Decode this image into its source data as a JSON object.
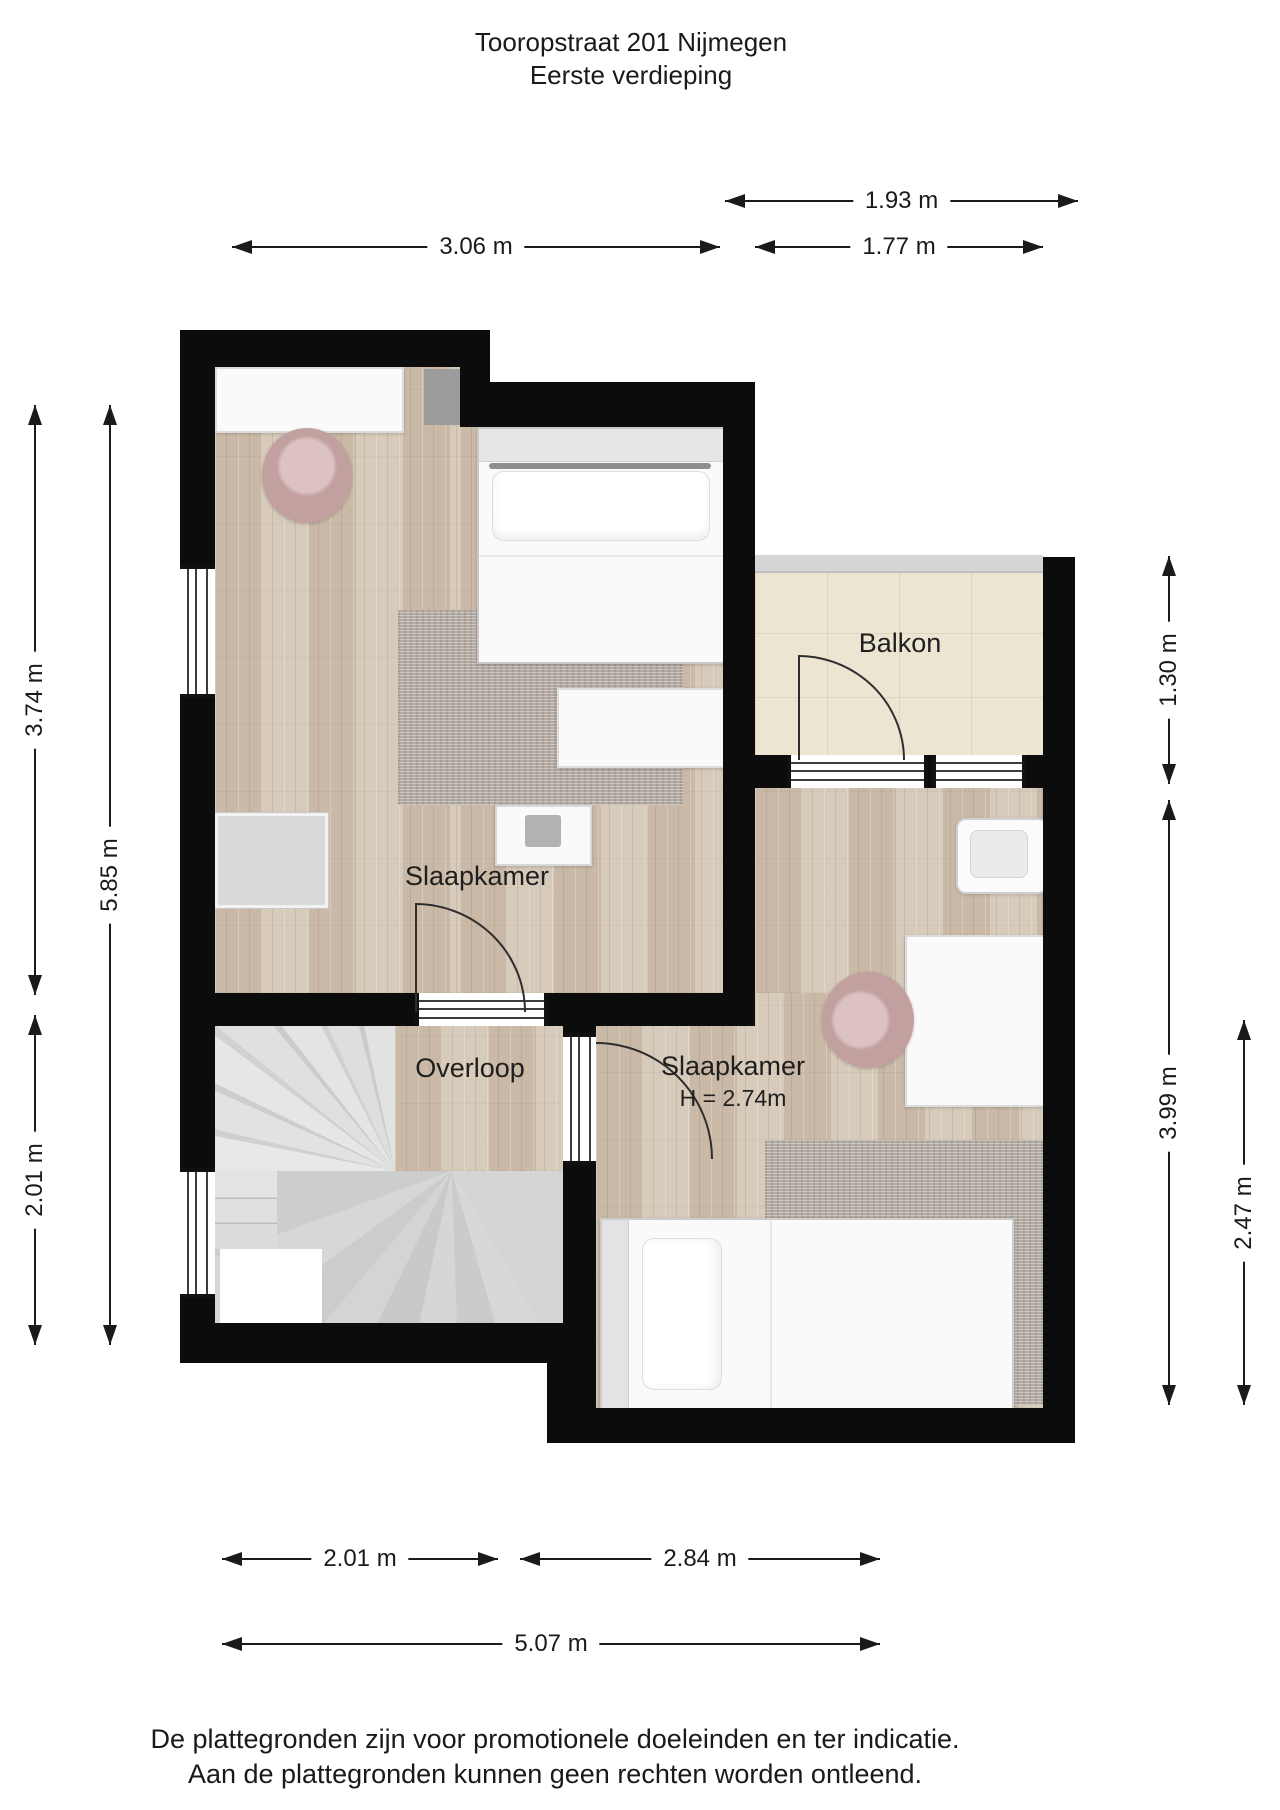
{
  "header": {
    "address": "Tooropstraat 201 Nijmegen",
    "floor": "Eerste verdieping"
  },
  "rooms": {
    "bedroom_left": {
      "label": "Slaapkamer"
    },
    "landing": {
      "label": "Overloop"
    },
    "bedroom_right": {
      "label": "Slaapkamer",
      "ceiling_height": "H = 2.74m"
    },
    "balcony": {
      "label": "Balkon"
    }
  },
  "dimensions": {
    "balcony_width": "1.93 m",
    "bedroom_left_width": "3.06 m",
    "balcony_inner_width": "1.77 m",
    "bedroom_left_depth": "3.74 m",
    "left_side_total": "5.85 m",
    "landing_depth": "2.01 m",
    "balcony_depth": "1.30 m",
    "bedroom_right_depth": "3.99 m",
    "bedroom_right_lower_depth": "2.47 m",
    "landing_width": "2.01 m",
    "bedroom_right_width": "2.84 m",
    "total_width": "5.07 m"
  },
  "footer": {
    "line1": "De plattegronden zijn voor promotionele doeleinden en ter indicatie.",
    "line2": "Aan de plattegronden kunnen geen rechten worden ontleend."
  },
  "colors": {
    "wall": "#0c0c0c",
    "wood_floor": "#d0c2b0",
    "balcony_tile": "#ebe5d2",
    "stairs": "#d5d5d5",
    "rug": "#b3aba3",
    "chair": "#c2a0a0",
    "furniture": "#fafafa",
    "dimension_line": "#1a1a1a"
  }
}
